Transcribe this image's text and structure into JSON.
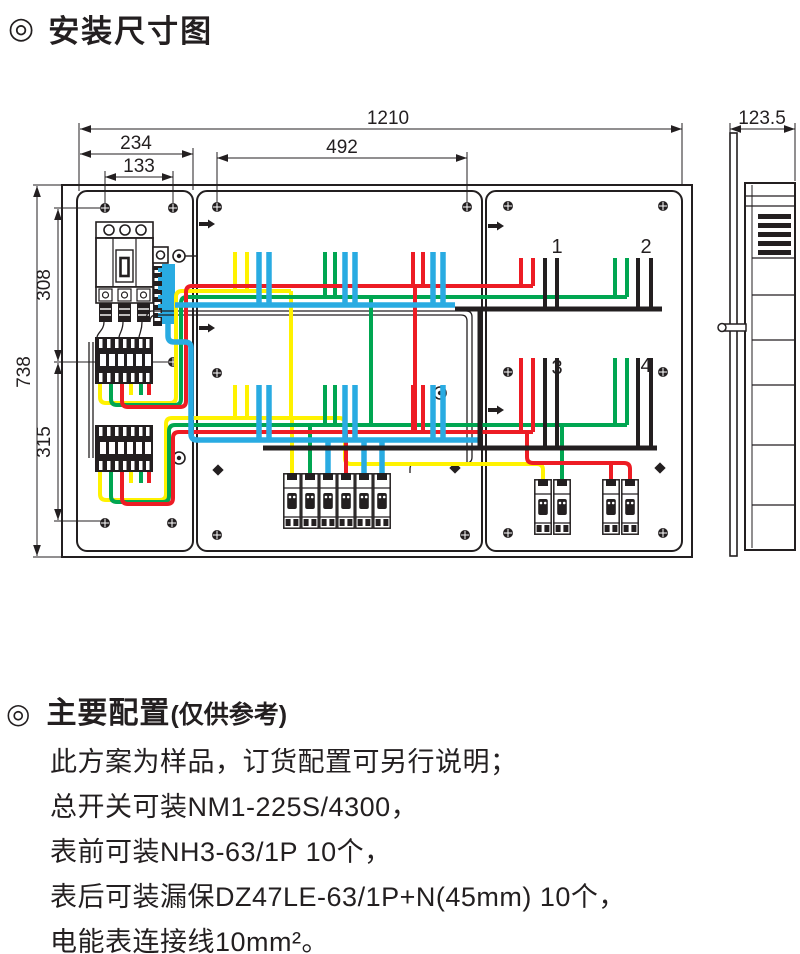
{
  "page": {
    "background": "#ffffff",
    "text_color": "#231f20"
  },
  "title": {
    "bullet": "◎",
    "text": "安装尺寸图"
  },
  "diagram": {
    "dims": {
      "total_width": "1210",
      "left_plate_width": "234",
      "left_holes_span": "133",
      "middle_holes_span": "492",
      "depth": "123.5",
      "total_height": "738",
      "upper_span": "308",
      "lower_span": "315"
    },
    "meter_labels": [
      "1",
      "2",
      "3",
      "4"
    ],
    "wire_colors": {
      "phase_a_yellow": "#fff200",
      "phase_b_green": "#00a651",
      "phase_c_red": "#ed1c24",
      "neutral_blue": "#29abe2",
      "black_line": "#231f20"
    }
  },
  "config": {
    "bullet": "◎",
    "heading": "主要配置",
    "heading_note": "(仅供参考)",
    "lines": [
      "此方案为样品，订货配置可另行说明；",
      "总开关可装NM1-225S/4300，",
      "表前可装NH3-63/1P  10个，",
      "表后可装漏保DZ47LE-63/1P+N(45mm)   10个，",
      "电能表连接线10mm²。"
    ]
  }
}
